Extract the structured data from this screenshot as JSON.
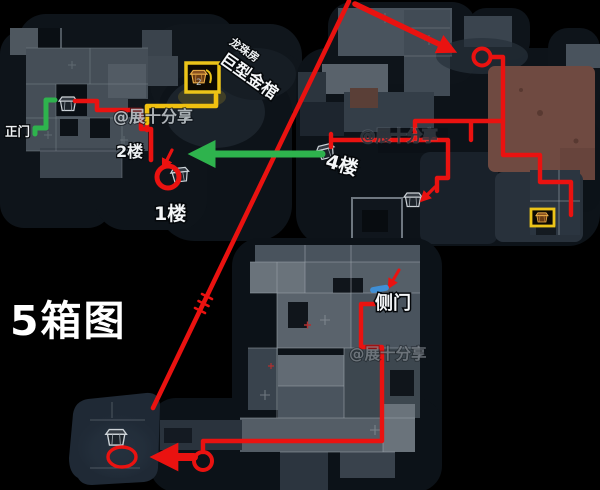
{
  "title": {
    "text": "5箱图"
  },
  "map_labels": {
    "main_gate": "正门",
    "floor_2": "2楼",
    "floor_1": "1楼",
    "floor_4": "4楼",
    "side_door": "侧门",
    "dragon_pearl_room": "龙珠房",
    "giant_golden_coffin": "巨型金棺",
    "box_count_badge": "2"
  },
  "watermarks": {
    "top_left": "@展十分享",
    "center": "@展十分享",
    "bottom": "@展十分享"
  },
  "colors": {
    "background": "#000000",
    "route_red": "#ea1210",
    "route_green": "#2eb34d",
    "route_yellow": "#f0c010",
    "chest_box_yellow": "#ecc419",
    "door_marker_blue": "#3f8fd6",
    "treasure_room_brown": "#6f4a41"
  }
}
